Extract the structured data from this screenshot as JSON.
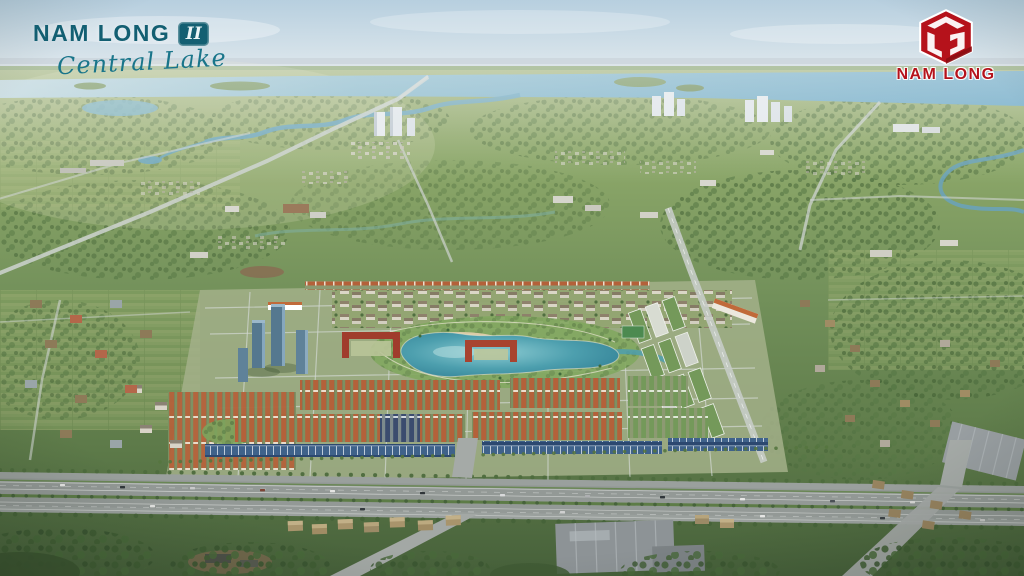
{
  "page": {
    "title": "Nam Long II Central Lake"
  },
  "branding": {
    "project": {
      "name": "NAM LONG",
      "phase_badge": "II",
      "tagline": "Central Lake"
    },
    "developer": {
      "name": "NAM LONG"
    }
  },
  "palette": {
    "brandTeal": "#135f72",
    "brandRed": "#b5121b",
    "sky": "#c5d9e6",
    "river": "#7db3cd",
    "lake": "#3f90a4",
    "greenery": "#6d8a55",
    "roofTerracotta": "#b4613a",
    "roofSolarBlue": "#2e4a74",
    "roofGreen": "#74995a",
    "road": "#9aa09d",
    "sand": "#dccca6"
  }
}
